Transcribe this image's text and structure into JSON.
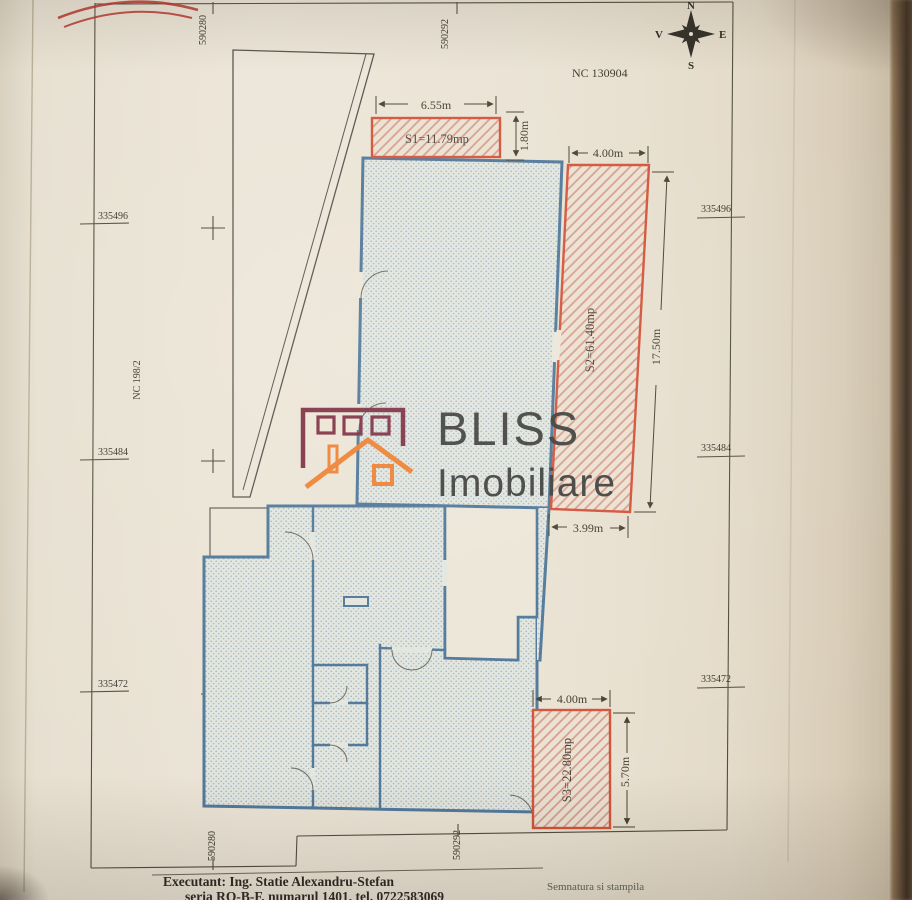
{
  "plan": {
    "nc_title": "NC 130904",
    "neighbor_parcel": "NC 198/2",
    "compass": {
      "n": "N",
      "s": "S",
      "e": "E",
      "w": "V"
    },
    "grid": {
      "eastings": [
        "590280",
        "590292"
      ],
      "northings": [
        "335496",
        "335484",
        "335472"
      ]
    },
    "areas": [
      {
        "id": "S1",
        "label": "S1=11.79mp"
      },
      {
        "id": "S2",
        "label": "S2=61.40mp"
      },
      {
        "id": "S3",
        "label": "S3=22.80mp"
      }
    ],
    "dimensions": {
      "s1_width": "6.55m",
      "s1_offset": "1.80m",
      "s2_width": "4.00m",
      "s2_length": "17.50m",
      "s2_bottom": "3.99m",
      "s3_width": "4.00m",
      "s3_length": "5.70m"
    }
  },
  "footer": {
    "executant": "Executant: Ing. Statie Alexandru-Stefan",
    "executant_details": "seria RO-B-F, numarul 1401, tel. 0722583069",
    "signature_label": "Semnatura si stampila"
  },
  "watermark": {
    "brand": "BLISS",
    "brand_sub": "Imobiliare",
    "accent_orange": "#ef7f2e",
    "accent_maroon": "#7c2b3e"
  }
}
